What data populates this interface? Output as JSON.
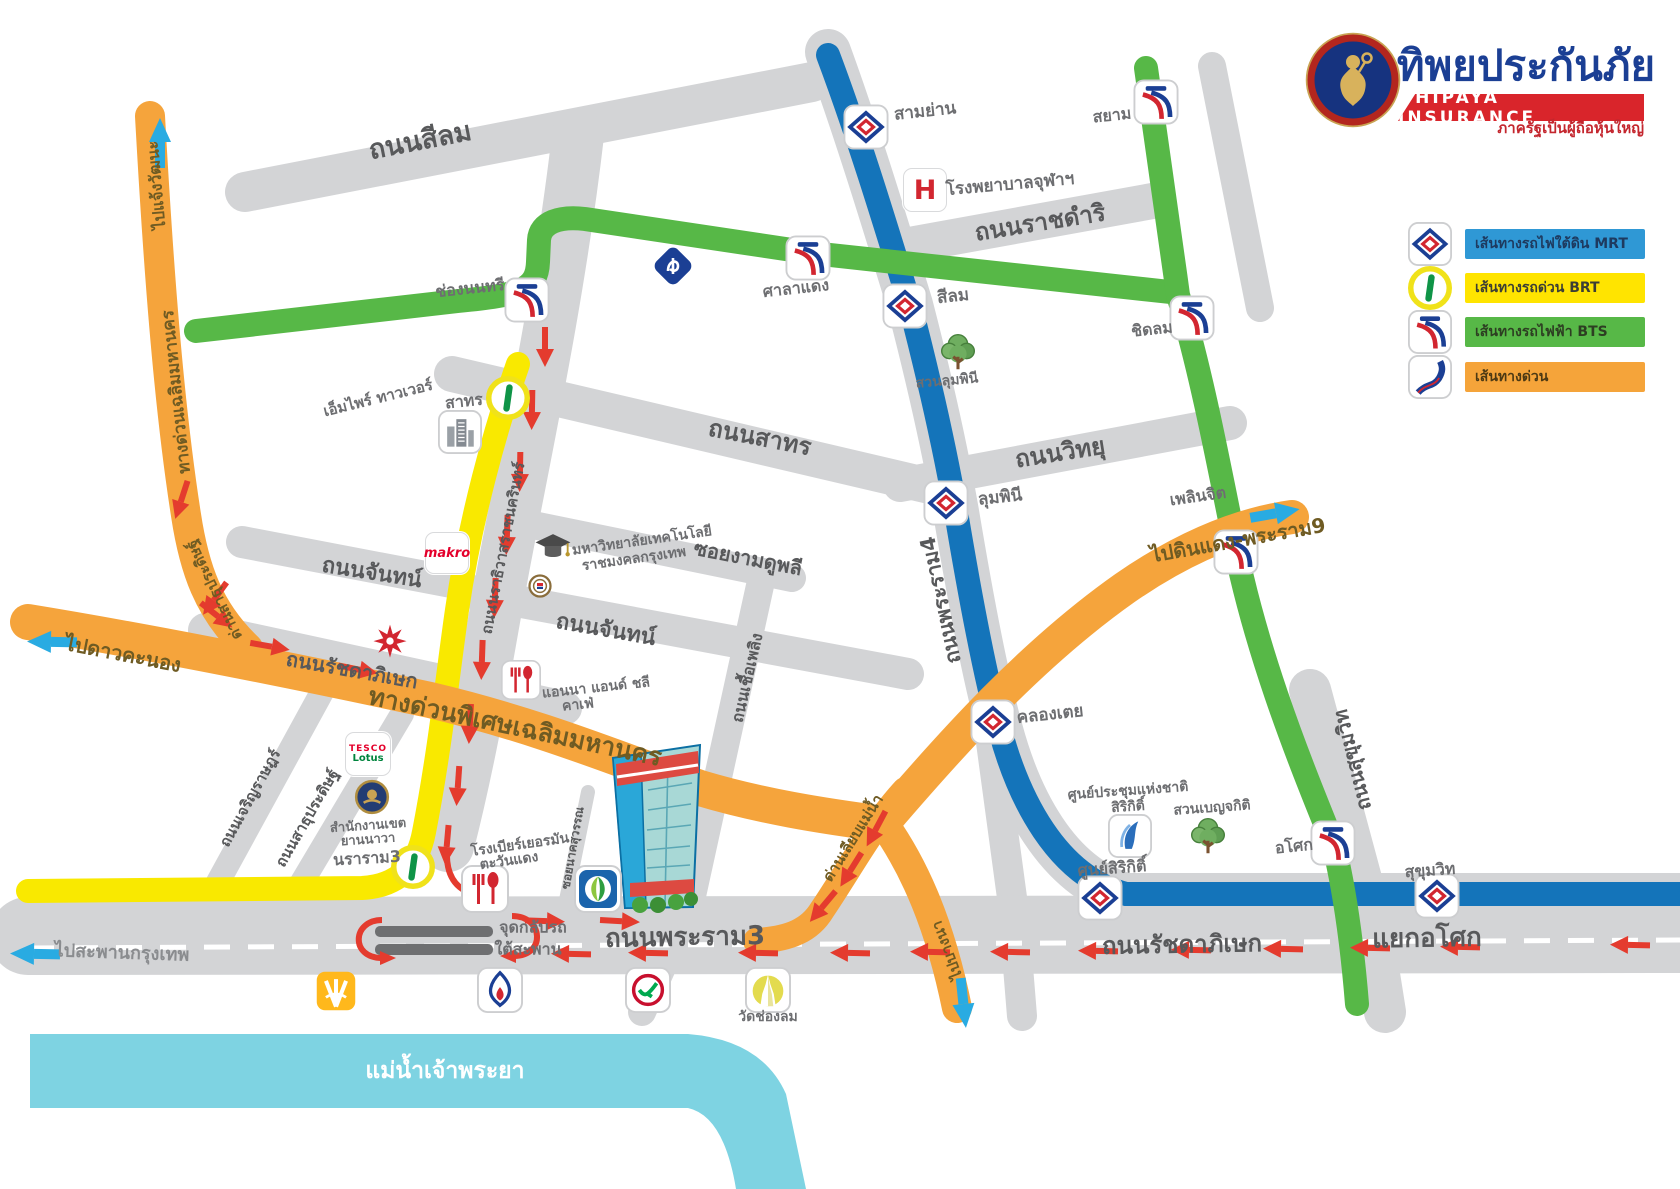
{
  "logo": {
    "title": "ทิพยประกันภัย",
    "banner": "DHIPAYA INSURANCE",
    "tagline": "ภาครัฐเป็นผู้ถือหุ้นใหญ่"
  },
  "legend": {
    "mrt": "เส้นทางรถไฟใต้ดิน MRT",
    "brt": "เส้นทางรถด่วน BRT",
    "bts": "เส้นทางรถไฟฟ้า BTS",
    "expressway": "เส้นทางด่วน"
  },
  "roads": {
    "silom": "ถนนสีลม",
    "ratchadamri": "ถนนราชดำริ",
    "sathorn": "ถนนสาทร",
    "witthayu": "ถนนวิทยุ",
    "ngam_duphli": "ซอยงามดูพลี",
    "chan_west": "ถนนจันทน์",
    "chan_east": "ถนนจันทน์",
    "rama4": "ถนนพระราม4",
    "narathiwat": "ถนนนราธิวาสราชนครินทร์",
    "ratchadaphisek_west": "ถนนรัชดาภิเษก",
    "ratchadaphisek_east": "ถนนรัชดาภิเษก",
    "rama3": "ถนนพระราม3",
    "asok_intersection": "แยกอโศก",
    "sukhumvit": "ถนนสุขุมวิท",
    "charoen_rat": "ถนนเจริญราษฎร์",
    "sathu_pradit": "ถนนสาธุประดิษฐ์",
    "chuea_phloeng": "ถนนเชื้อเพลิง",
    "nak_suwan": "ซอยนาคสุวรรณ"
  },
  "expressway": {
    "main": "ทางด่วนพิเศษเฉลิมมหานคร",
    "left_line": "ทางด่วนเฉลิมมหานคร",
    "toll_sathu_pradit": "ด่านสาธุประดิษฐ์",
    "toll_liap_maenam": "ด่านเลียบแม่น้ำ"
  },
  "directions": {
    "chaengwatthana": "ไปแจ้งวัฒนะ",
    "dao_khanong": "ไปดาวคะนอง",
    "krungthep_bridge": "ไปสะพานกรุงเทพ",
    "dindaeng_rama9": "ไปดินแดง-พระราม9",
    "bangna": "ไปบางนา"
  },
  "stations": {
    "mrt": {
      "sam_yan": "สามย่าน",
      "silom": "สีลม",
      "lumphini": "ลุมพินี",
      "khlong_toei": "คลองเตย",
      "sirikit_center": "ศูนย์สิริกิติ์",
      "sukhumvit": "สุขุมวิท"
    },
    "bts": {
      "sala_daeng": "ศาลาแดง",
      "chong_nonsi": "ช่องนนทรี",
      "siam": "สยาม",
      "chit_lom": "ชิดลม",
      "phloen_chit": "เพลินจิต",
      "asok": "อโศก"
    },
    "brt": {
      "sathorn": "สาทร",
      "nararam3": "นราราม3"
    }
  },
  "places": {
    "chula_hospital": "โรงพยาบาลจุฬาฯ",
    "hospital_symbol": "H",
    "lumphini_park": "สวนลุมพินี",
    "benjakitti_park": "สวนเบญจกิติ",
    "sirikit_center_line1": "ศูนย์ประชุมแห่งชาติ",
    "sirikit_center_line2": "สิริกิติ์",
    "empire_tower": "เอ็มไพร์ ทาวเวอร์",
    "rmutk_line1": "มหาวิทยาลัยเทคโนโลยี",
    "rmutk_line2": "ราชมงคลกรุงเทพ",
    "makro": "makro",
    "tesco_line1": "TESCO",
    "tesco_line2": "Lotus",
    "anna_cafe_line1": "แอนนา แอนด์ ชลี",
    "anna_cafe_line2": "คาเฟ่",
    "german_brewery_line1": "โรงเบียร์เยอรมัน",
    "german_brewery_line2": "ตะวันแดง",
    "yannawa_office_line1": "สำนักงานเขต",
    "yannawa_office_line2": "ยานนาวา",
    "wat_chong_lom": "วัดช่องลม",
    "u_turn_line1": "จุดกลับรถ",
    "u_turn_line2": "ใต้สะพาน",
    "river": "แม่น้ำเจ้าพระยา"
  },
  "colors": {
    "mrt_line": "#1474ba",
    "brt_line": "#f9e900",
    "bts_line": "#57b847",
    "expressway_line": "#f5a43c",
    "road_gray": "#d3d4d6",
    "river_cyan": "#7ed3e2",
    "arrow_red": "#e43b2e",
    "arrow_blue": "#29abe2",
    "logo_navy": "#1b3f94",
    "logo_red": "#d9252b",
    "label_gray": "#58595b"
  },
  "icons": {
    "mrt_station": "mrt-diamond-logo",
    "bts_station": "bts-wave-logo",
    "brt_station": "brt-green-bar-circle",
    "expressway_legend": "blue-s-road",
    "tree": "park-tree",
    "hospital": "red-h",
    "bangkok_bank": "navy-diamond",
    "fork_spoon": "restaurant-utensils",
    "temple": "yellow-chedi",
    "building_3d": "dhipaya-tower"
  }
}
